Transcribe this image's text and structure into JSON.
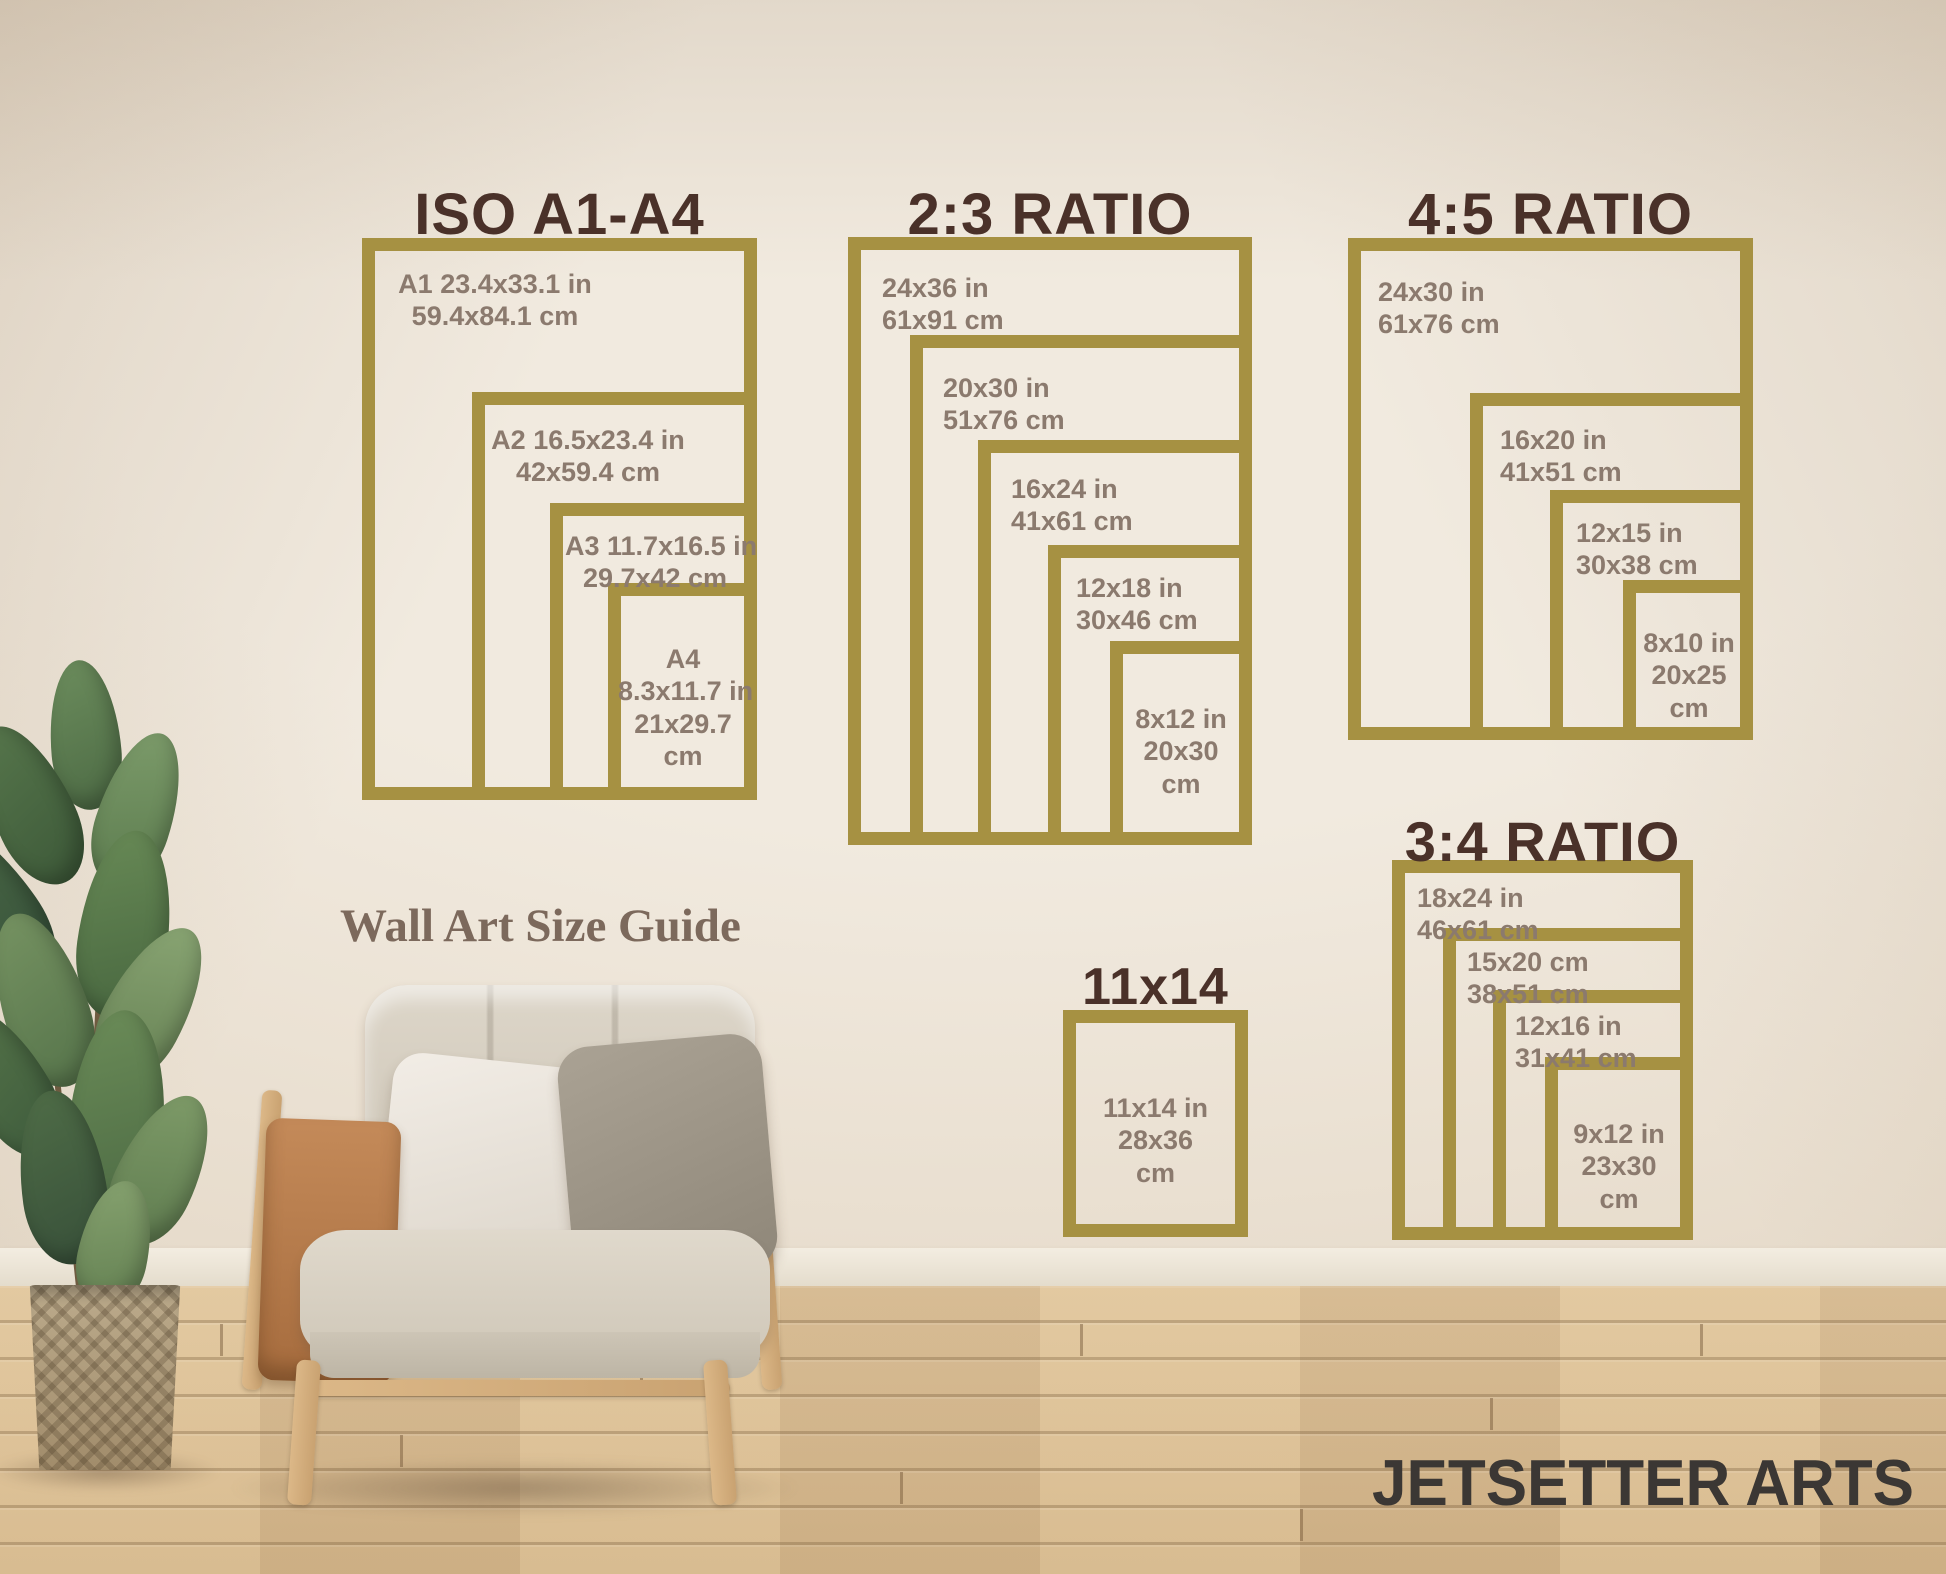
{
  "heading": {
    "text": "Wall Art Size Guide"
  },
  "brand": {
    "text": "JETSETTER ARTS"
  },
  "colors": {
    "frame_gold": "#a69142",
    "title_brown": "#4a3129",
    "label_taupe": "#8b7a6e",
    "heading_brown": "#7c695c",
    "brand_charcoal": "#3b3734"
  },
  "sections": [
    {
      "title": "ISO A1-A4",
      "sizes": [
        {
          "lines": [
            "A1 23.4x33.1 in",
            "59.4x84.1 cm"
          ]
        },
        {
          "lines": [
            "A2 16.5x23.4 in",
            "42x59.4 cm"
          ]
        },
        {
          "lines": [
            "A3 11.7x16.5 in",
            "29.7x42 cm"
          ]
        },
        {
          "lines": [
            "A4",
            "8.3x11.7 in",
            "21x29.7",
            "cm"
          ]
        }
      ]
    },
    {
      "title": "2:3 RATIO",
      "sizes": [
        {
          "lines": [
            "24x36 in",
            "61x91 cm"
          ]
        },
        {
          "lines": [
            "20x30 in",
            "51x76 cm"
          ]
        },
        {
          "lines": [
            "16x24 in",
            "41x61 cm"
          ]
        },
        {
          "lines": [
            "12x18 in",
            "30x46 cm"
          ]
        },
        {
          "lines": [
            "8x12 in",
            "20x30",
            "cm"
          ]
        }
      ]
    },
    {
      "title": "4:5 RATIO",
      "sizes": [
        {
          "lines": [
            "24x30 in",
            "61x76 cm"
          ]
        },
        {
          "lines": [
            "16x20 in",
            "41x51 cm"
          ]
        },
        {
          "lines": [
            "12x15 in",
            "30x38 cm"
          ]
        },
        {
          "lines": [
            "8x10 in",
            "20x25",
            "cm"
          ]
        }
      ]
    },
    {
      "title": "3:4 RATIO",
      "sizes": [
        {
          "lines": [
            "18x24 in",
            "46x61 cm"
          ]
        },
        {
          "lines": [
            "15x20 cm",
            "38x51 cm"
          ]
        },
        {
          "lines": [
            "12x16 in",
            "31x41 cm"
          ]
        },
        {
          "lines": [
            "9x12 in",
            "23x30",
            "cm"
          ]
        }
      ]
    },
    {
      "title": "11x14",
      "sizes": [
        {
          "lines": [
            "11x14 in",
            "28x36",
            "cm"
          ]
        }
      ]
    }
  ]
}
